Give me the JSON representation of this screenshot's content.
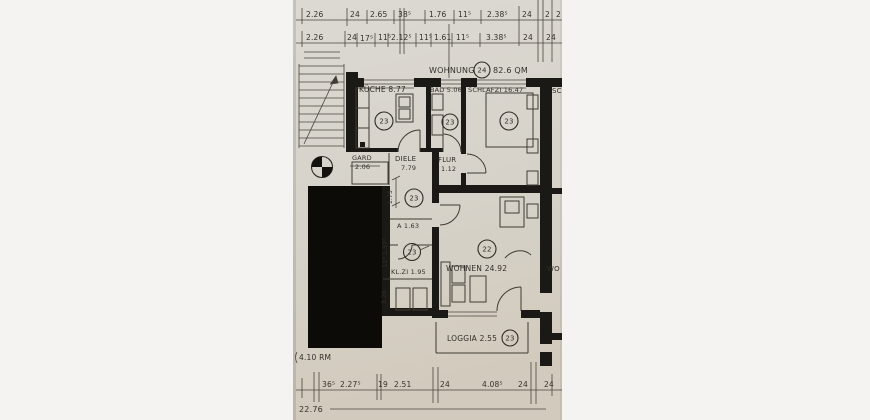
{
  "photo": {
    "title": {
      "name": "WOHNUNG",
      "circle": "24",
      "area": "82.6 QM"
    },
    "rooms": {
      "kueche": {
        "label": "KÜCHE 8.77",
        "circle": "23"
      },
      "bad": {
        "label": "BAD 5.06",
        "circle": "23"
      },
      "schlafzi": {
        "label": "SCHLAFZI 16.47",
        "circle": "23"
      },
      "gard": {
        "label": "GARD",
        "area": "2.06"
      },
      "diele": {
        "label": "DIELE",
        "area": "7.79",
        "circle": "23"
      },
      "flur": {
        "label": "FLUR",
        "area": "1.12"
      },
      "abstell": {
        "label": "A 1.63"
      },
      "klzi": {
        "label": "KL.ZI 1.95",
        "circle": "23"
      },
      "wohnen": {
        "label": "WOHNEN 24.92",
        "circle": "22"
      },
      "loggia": {
        "label": "LOGGIA 2.55",
        "circle": "23"
      }
    },
    "adjacent": {
      "top": "SC",
      "mid": "WO"
    },
    "dims": {
      "top1": [
        "2.26",
        "24",
        "2.65",
        "38⁵",
        "1.76",
        "11⁵",
        "2.38⁵",
        "24",
        "2",
        "2"
      ],
      "top2": [
        "2.26",
        "24",
        "17⁵",
        "11⁵",
        "2.12⁵",
        "11⁵",
        "1.61",
        "11⁵",
        "3.38⁵",
        "24",
        "24"
      ],
      "bottom": [
        "36⁵",
        "2.27⁵",
        "19",
        "2.51",
        "24",
        "4.08⁵",
        "24",
        "24"
      ],
      "left": [
        "1.75",
        "11⁵ 1.37⁵",
        "3.26"
      ],
      "total": "22.76",
      "note": "4.10 RM"
    }
  }
}
